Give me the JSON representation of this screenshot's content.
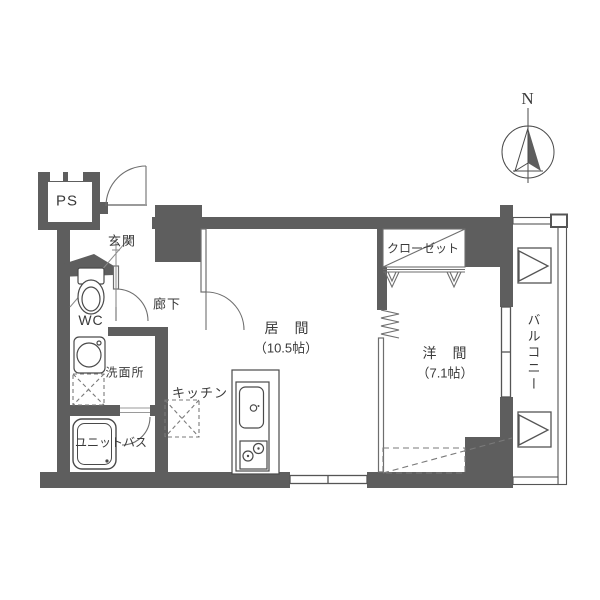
{
  "compass": {
    "north_label": "N"
  },
  "rooms": {
    "ps": "PS",
    "genkan": "玄関",
    "wc": "WC",
    "hallway": "廊下",
    "washroom": "洗面所",
    "unit_bath": "ユニットバス",
    "kitchen": "キッチン",
    "living_room": "居　間",
    "living_room_size": "（10.5帖）",
    "closet": "クローゼット",
    "western_room": "洋　間",
    "western_room_size": "（7.1帖）",
    "balcony": "バルコニー"
  },
  "fixtures": [
    "compass-north-icon",
    "toilet-icon",
    "washbasin-icon",
    "washer-space-icon",
    "bathtub-icon",
    "kitchen-sink-icon",
    "stove-icon",
    "refrigerator-space-icon",
    "closet-hanger-icon",
    "balcony-hatch-icon",
    "door-swing",
    "accordion-door",
    "sliding-window"
  ],
  "colors": {
    "wall": "#5e5e5e",
    "thin_line": "#6e6e6e",
    "fixture_line": "#4a4a4a",
    "text": "#3a3a3a",
    "background": "#ffffff"
  }
}
